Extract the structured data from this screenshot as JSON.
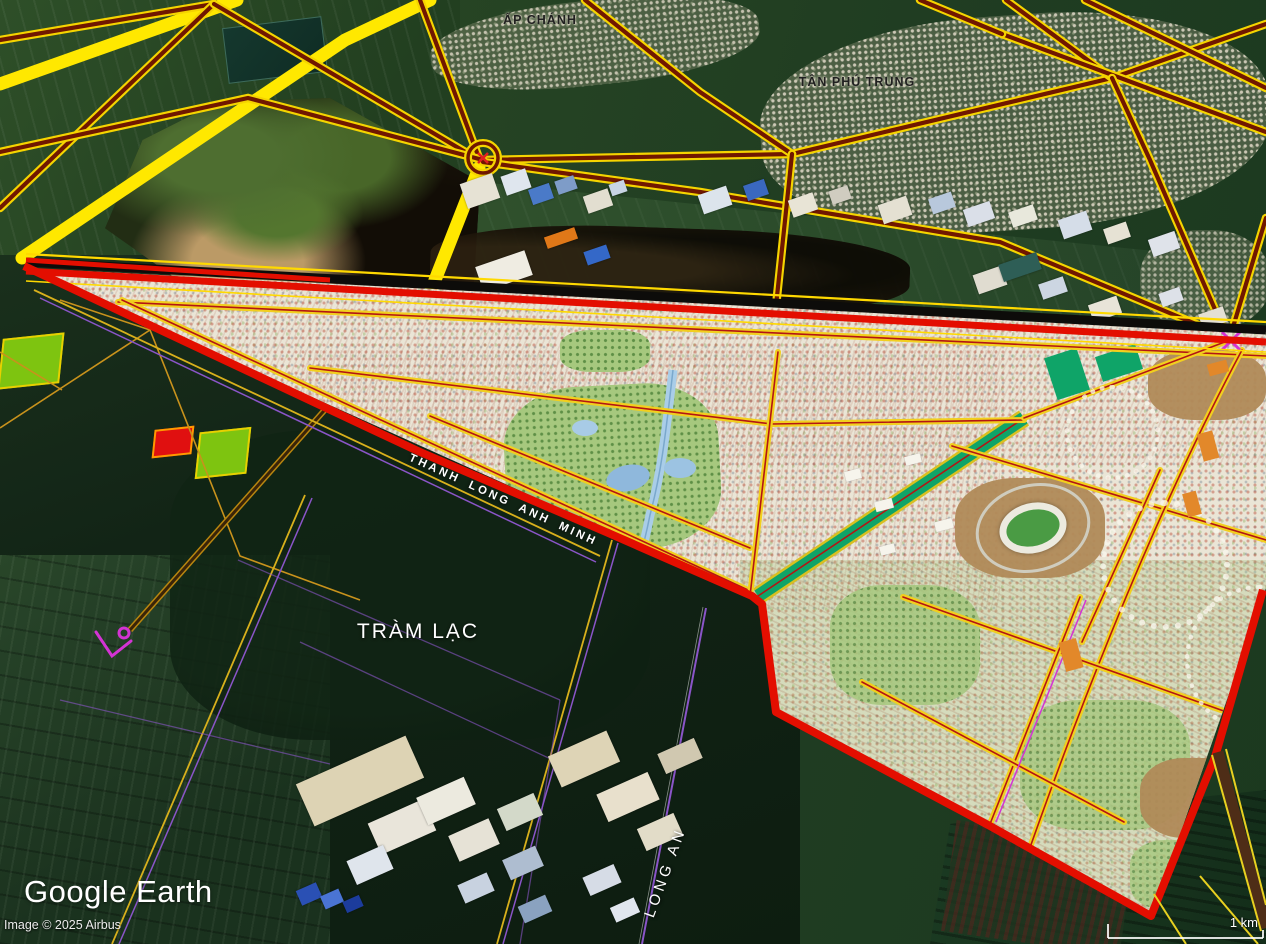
{
  "app": {
    "logo_text": "Google Earth"
  },
  "attribution": {
    "copyright": "Image © 2025 Airbus"
  },
  "scale_bar": {
    "label": "1 km"
  },
  "labels": {
    "place_top_center": "ẤP CHÁNH",
    "place_top_right": "TÂN PHÚ TRUNG",
    "place_mid_left": "TRÀM LẠC",
    "place_bottom": "LONG AN",
    "road_label": "THANH LONG ANH MINH"
  },
  "colors": {
    "road_yellow": "#f5d400",
    "road_dark": "#701700",
    "wide_yellow": "#ffe800",
    "boundary_red": "#e30e00",
    "boundary_black": "#0d0c0a",
    "teal_band": "#0fa468",
    "dev_base": "#eae5d6",
    "purple_line": "#8a55c8",
    "magenta": "#d433d4",
    "park_green": "#a6c87e",
    "parcel_green": "#7ec410",
    "parcel_red": "#e01010"
  }
}
